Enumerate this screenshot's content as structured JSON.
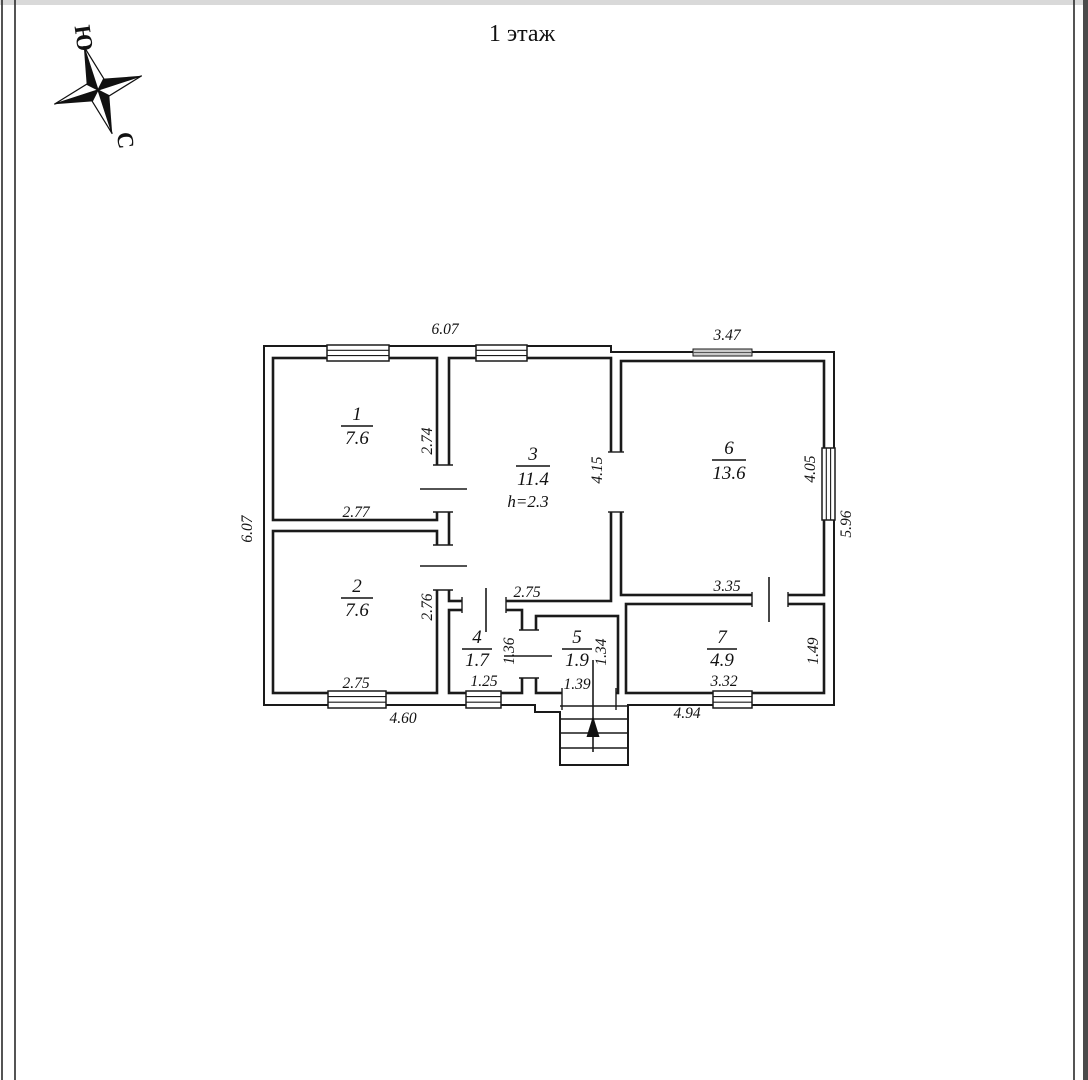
{
  "page": {
    "title": "1 этаж"
  },
  "compass": {
    "south_label": "Ю",
    "north_label": "С",
    "south_color": "#cc1111",
    "north_color": "#1111bb"
  },
  "plan": {
    "rooms": [
      {
        "number": "1",
        "area": "7.6",
        "bottom_dim": "2.77",
        "side_dim": "2.74"
      },
      {
        "number": "2",
        "area": "7.6",
        "bottom_dim": "2.75",
        "side_dim": "2.76"
      },
      {
        "number": "3",
        "area": "11.4",
        "height_note": "h=2.3",
        "bottom_dim": "2.75",
        "side_dim": "4.15"
      },
      {
        "number": "4",
        "area": "1.7",
        "bottom_dim": "1.25",
        "side_dim": "1.36"
      },
      {
        "number": "5",
        "area": "1.9",
        "bottom_dim": "1.39",
        "side_dim": "1.34"
      },
      {
        "number": "6",
        "area": "13.6",
        "bottom_dim": "3.35",
        "side_dim": "4.05"
      },
      {
        "number": "7",
        "area": "4.9",
        "bottom_dim": "3.32",
        "side_dim": "1.49"
      }
    ],
    "exterior_dims": {
      "top_width": "6.07",
      "top_right_width": "3.47",
      "left_height": "6.07",
      "right_height": "5.96",
      "bottom_left_width": "4.60",
      "bottom_right_width": "4.94"
    }
  }
}
